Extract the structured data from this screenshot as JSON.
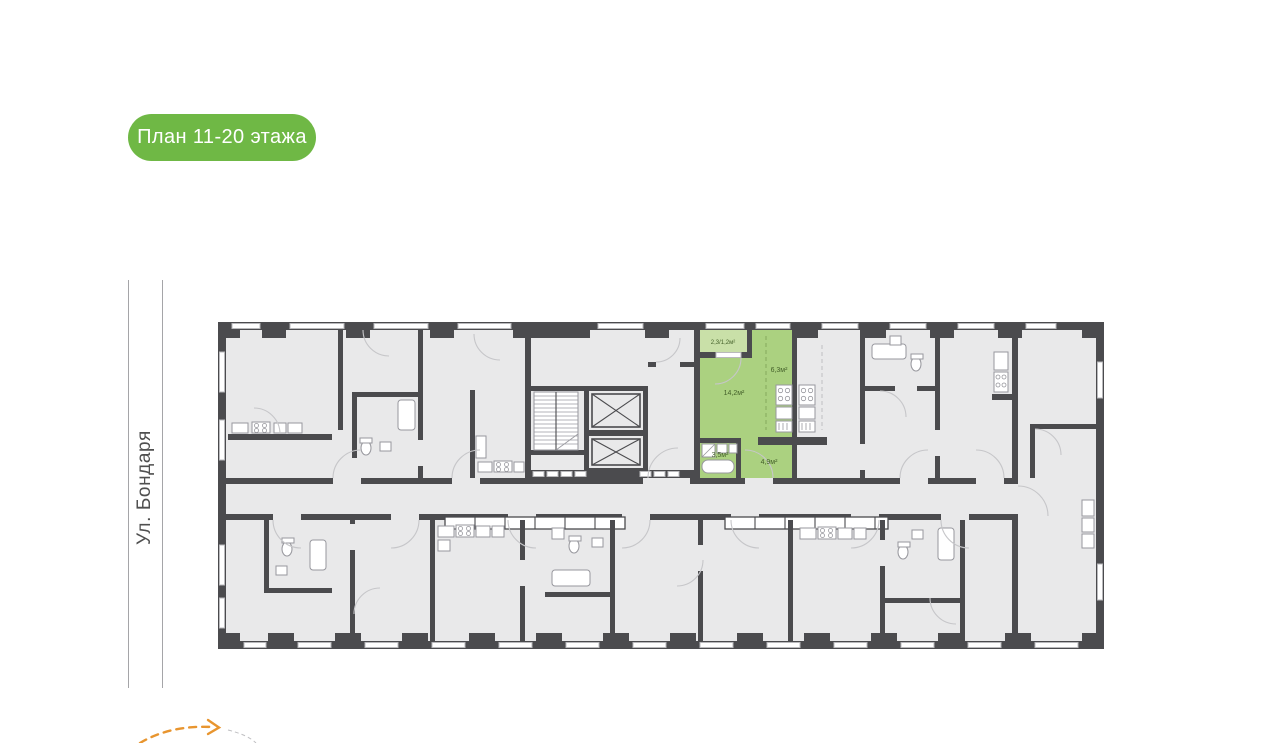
{
  "badge": {
    "label": "План 11-20 этажа"
  },
  "street": {
    "label": "Ул. Бондаря"
  },
  "highlighted_apartment": {
    "balcony_area_label": "2,3/1,2м²",
    "living_room_area_label": "14,2м²",
    "kitchen_area_label": "6,3м²",
    "bathroom_area_label": "3,5м²",
    "hallway_area_label": "4,9м²"
  },
  "colors": {
    "badge_green": "#6fb845",
    "apartment_green": "#abd180",
    "balcony_green": "#c9e0a8",
    "area_label_green": "#44602a",
    "wall_dark": "#4b4b4e",
    "room_gray": "#e9e9ea",
    "street_arrow_orange": "#e8952f"
  }
}
